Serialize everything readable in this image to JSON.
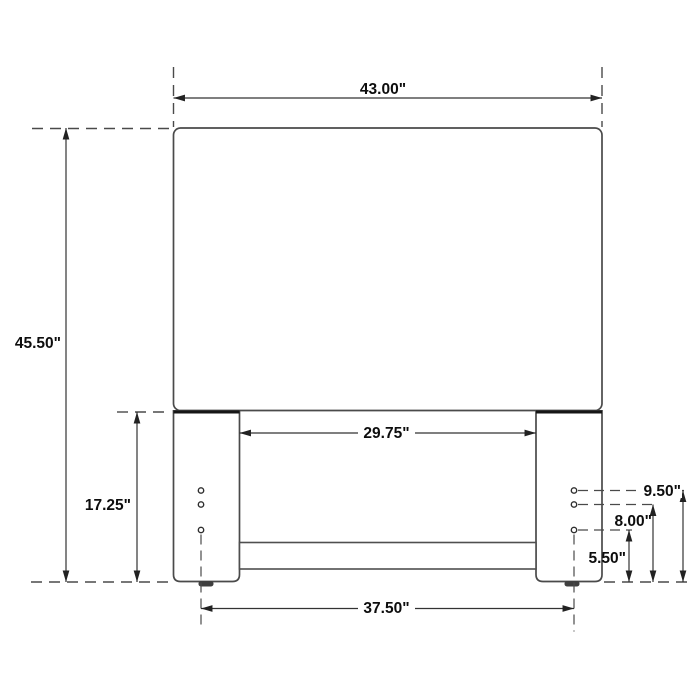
{
  "canvas": {
    "background": "#ffffff",
    "outline_color": "#4a4a4a",
    "dimension_line_color": "#333333",
    "dimension_text_color": "#0d0d0d",
    "bold_edge_color": "#161616"
  },
  "diagram": {
    "kind": "furniture-dimension-drawing",
    "subject": "headboard front elevation with two legs, cross rail and bolt holes",
    "units": "inches",
    "holes_per_leg": 3,
    "dimensions": [
      {
        "id": "overall-width",
        "label": "43.00\"",
        "inches": 43.0,
        "orientation": "horizontal"
      },
      {
        "id": "overall-height",
        "label": "45.50\"",
        "inches": 45.5,
        "orientation": "vertical"
      },
      {
        "id": "leg-height",
        "label": "17.25\"",
        "inches": 17.25,
        "orientation": "vertical"
      },
      {
        "id": "inner-leg-span",
        "label": "29.75\"",
        "inches": 29.75,
        "orientation": "horizontal"
      },
      {
        "id": "bolt-hole-span",
        "label": "37.50\"",
        "inches": 37.5,
        "orientation": "horizontal"
      },
      {
        "id": "top-hole-height",
        "label": "9.50\"",
        "inches": 9.5,
        "orientation": "vertical"
      },
      {
        "id": "middle-hole-height",
        "label": "8.00\"",
        "inches": 8.0,
        "orientation": "vertical"
      },
      {
        "id": "bottom-hole-height",
        "label": "5.50\"",
        "inches": 5.5,
        "orientation": "vertical"
      }
    ]
  }
}
